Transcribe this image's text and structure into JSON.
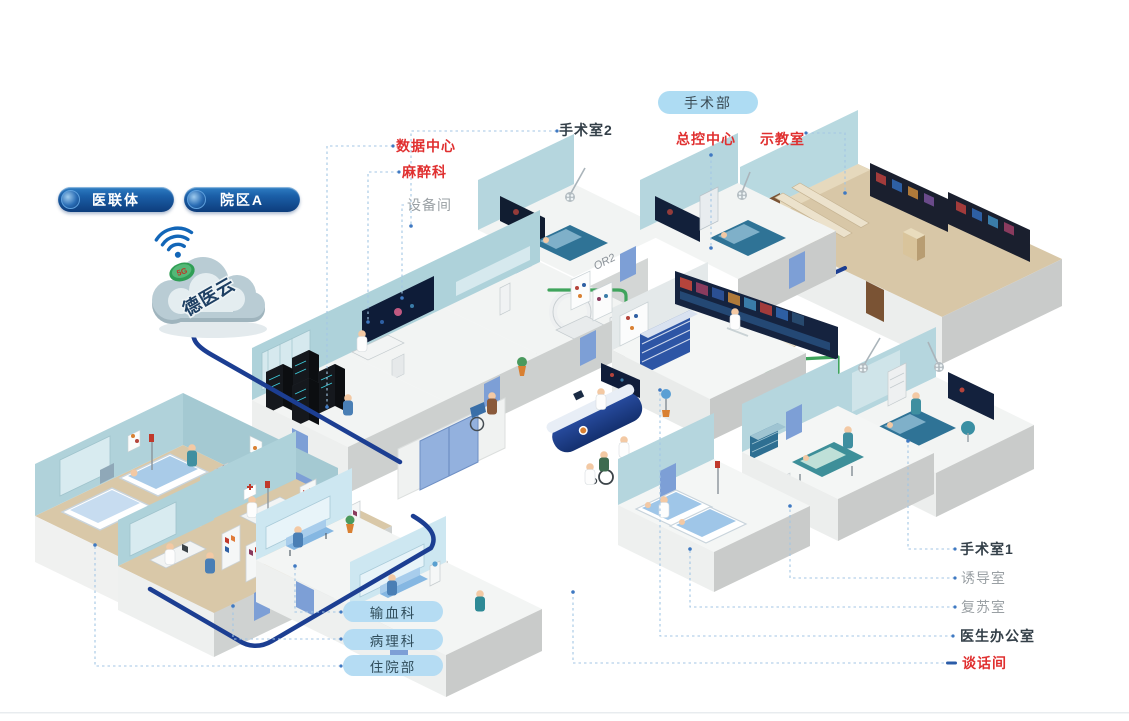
{
  "cloud": {
    "label": "德医云",
    "badge": "5G"
  },
  "org_pills": [
    {
      "label": "医联体"
    },
    {
      "label": "院区A"
    }
  ],
  "department_pill": {
    "label": "手术部"
  },
  "top_labels": [
    {
      "id": "data-center",
      "label": "数据中心",
      "style": "red"
    },
    {
      "id": "anesthesiology",
      "label": "麻醉科",
      "style": "red"
    },
    {
      "id": "equipment-room",
      "label": "设备间",
      "style": "gray"
    },
    {
      "id": "operating-room-2",
      "label": "手术室2",
      "style": "dark"
    },
    {
      "id": "master-control-center",
      "label": "总控中心",
      "style": "red"
    },
    {
      "id": "demo-classroom",
      "label": "示教室",
      "style": "red"
    }
  ],
  "right_labels": [
    {
      "id": "operating-room-1",
      "label": "手术室1",
      "style": "dark"
    },
    {
      "id": "induction-room",
      "label": "诱导室",
      "style": "gray"
    },
    {
      "id": "recovery-room",
      "label": "复苏室",
      "style": "gray"
    },
    {
      "id": "doctor-office",
      "label": "医生办公室",
      "style": "dark"
    },
    {
      "id": "talk-room",
      "label": "谈话间",
      "style": "red"
    }
  ],
  "bottom_pills": [
    {
      "id": "blood-transfusion",
      "label": "输血科"
    },
    {
      "id": "pathology",
      "label": "病理科"
    },
    {
      "id": "inpatient",
      "label": "住院部"
    }
  ],
  "wall_tags": [
    {
      "label": "OR2"
    },
    {
      "label": "OR3"
    }
  ],
  "colors": {
    "label_red": "#e02f2f",
    "label_dark": "#333f48",
    "label_gray": "#9aa0a4",
    "pill_dark_blue_1": "#2f7fc4",
    "pill_dark_blue_2": "#0d3d7c",
    "pill_light_blue": "#aedcf3",
    "pill_sky": "#b5dcf3",
    "cable_blue": "#1c3e92",
    "cable_green": "#3fa45c",
    "leader_blue": "#a3c6e4",
    "cloud_text": "#1d3f63"
  }
}
